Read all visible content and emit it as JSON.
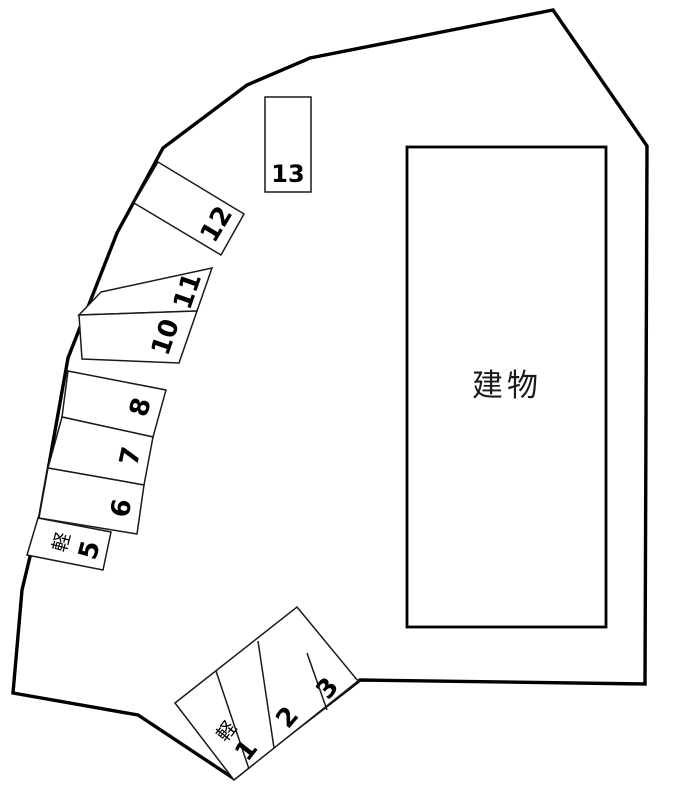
{
  "diagram": {
    "building_label": "建物",
    "kei_label": "軽",
    "stalls": {
      "s1": "1",
      "s2": "2",
      "s3": "3",
      "s5": "5",
      "s6": "6",
      "s7": "7",
      "s8": "8",
      "s10": "10",
      "s11": "11",
      "s12": "12",
      "s13": "13"
    }
  }
}
